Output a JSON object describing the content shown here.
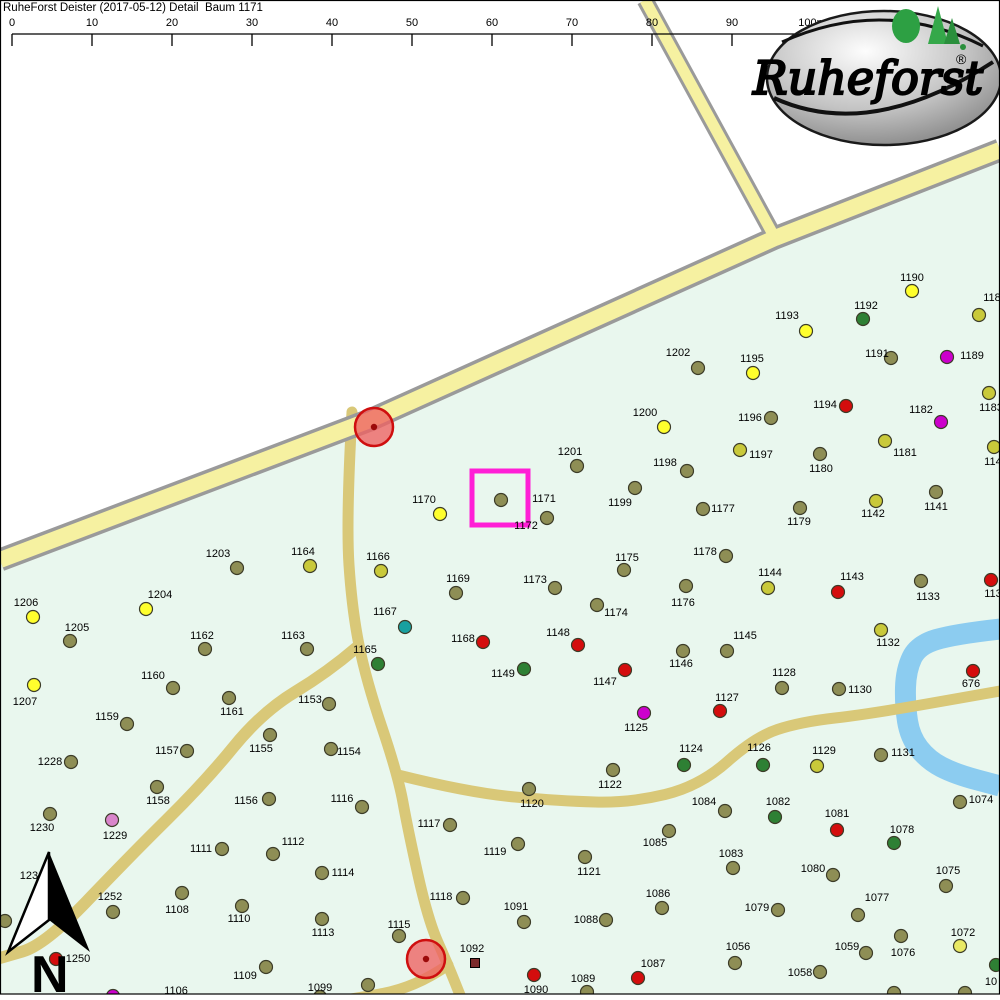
{
  "title": "RuheForst Deister (2017-05-12) Detail  Baum 1171",
  "north_label": "N",
  "logo": {
    "text": "Ruheforst",
    "reg": "®"
  },
  "scalebar": {
    "x0": 12,
    "dx": 80,
    "line_y": 34,
    "tick_h": 12,
    "label_y": 26,
    "labels": [
      "0",
      "10",
      "20",
      "30",
      "40",
      "50",
      "60",
      "70",
      "80",
      "90",
      "100m"
    ]
  },
  "colors": {
    "forest": "#e9f7ee",
    "water": "#8cccf0",
    "trail": "#d9c878",
    "road_border": "#9a9a9a",
    "road_fill": "#f6f1a1",
    "highlight": "#ff1fd6",
    "marker_fill": "#ee6161",
    "marker_border": "#cf0f0f",
    "marker_core": "#9c0a0a",
    "frame": "#000000"
  },
  "palette": {
    "olive": "#8e8e55",
    "dy": "#c9c93a",
    "y": "#ffff2d",
    "py": "#e9e964",
    "red": "#d40d0d",
    "green": "#2e8034",
    "mag": "#cc00cc",
    "teal": "#18a0a0",
    "pink": "#d985cb",
    "maroon": "#7c2b2b"
  },
  "map": {
    "forest": [
      [
        1000,
        152
      ],
      [
        775,
        238
      ],
      [
        370,
        420
      ],
      [
        0,
        558
      ],
      [
        0,
        1000
      ],
      [
        1000,
        1000
      ]
    ],
    "water": {
      "w": 21,
      "pts": [
        [
          1000,
          629
        ],
        [
          955,
          634
        ],
        [
          918,
          645
        ],
        [
          906,
          670
        ],
        [
          905,
          705
        ],
        [
          910,
          737
        ],
        [
          928,
          760
        ],
        [
          955,
          774
        ],
        [
          1000,
          786
        ]
      ]
    },
    "trails": [
      {
        "w": 11,
        "pts": [
          [
            352,
            412
          ],
          [
            346,
            520
          ],
          [
            352,
            610
          ],
          [
            366,
            680
          ],
          [
            398,
            775
          ],
          [
            408,
            830
          ],
          [
            428,
            920
          ],
          [
            448,
            965
          ],
          [
            462,
            1000
          ]
        ]
      },
      {
        "w": 11,
        "pts": [
          [
            448,
            965
          ],
          [
            415,
            988
          ],
          [
            345,
            1000
          ]
        ]
      },
      {
        "w": 11,
        "pts": [
          [
            398,
            775
          ],
          [
            470,
            793
          ],
          [
            560,
            801
          ],
          [
            630,
            803
          ],
          [
            700,
            786
          ],
          [
            755,
            737
          ],
          [
            800,
            722
          ],
          [
            870,
            714
          ],
          [
            1000,
            691
          ]
        ]
      },
      {
        "w": 12,
        "pts": [
          [
            356,
            648
          ],
          [
            328,
            672
          ],
          [
            262,
            712
          ],
          [
            205,
            782
          ],
          [
            130,
            856
          ],
          [
            45,
            945
          ],
          [
            0,
            958
          ]
        ]
      }
    ],
    "roads": [
      {
        "w": 16,
        "bw": 23,
        "pts": [
          [
            1000,
            150
          ],
          [
            775,
            238
          ],
          [
            370,
            420
          ],
          [
            0,
            560
          ]
        ]
      },
      {
        "w": 11,
        "bw": 17,
        "pts": [
          [
            645,
            0
          ],
          [
            775,
            238
          ]
        ]
      }
    ]
  },
  "markers": {
    "circles": [
      {
        "x": 374,
        "y": 427
      },
      {
        "x": 426,
        "y": 959
      }
    ],
    "highlight": {
      "x": 472,
      "y": 471,
      "w": 56,
      "h": 54
    }
  },
  "trees": [
    [
      "1190",
      912,
      291,
      912,
      277,
      "y"
    ],
    [
      "1192",
      863,
      319,
      866,
      305,
      "green"
    ],
    [
      "118",
      979,
      315,
      992,
      297,
      "dy"
    ],
    [
      "1191",
      891,
      358,
      877,
      353,
      "olive"
    ],
    [
      "1189",
      947,
      357,
      972,
      355,
      "mag"
    ],
    [
      "1183",
      989,
      393,
      991,
      407,
      "dy"
    ],
    [
      "1182",
      941,
      422,
      921,
      409,
      "mag"
    ],
    [
      "1181",
      885,
      441,
      905,
      452,
      "dy"
    ],
    [
      "1140",
      994,
      447,
      996,
      461,
      "dy"
    ],
    [
      "1194",
      846,
      406,
      825,
      404,
      "red"
    ],
    [
      "1193",
      806,
      331,
      787,
      315,
      "y"
    ],
    [
      "1195",
      753,
      373,
      752,
      358,
      "y"
    ],
    [
      "1202",
      698,
      368,
      678,
      352,
      "olive"
    ],
    [
      "1196",
      771,
      418,
      750,
      417,
      "olive"
    ],
    [
      "1200",
      664,
      427,
      645,
      412,
      "y"
    ],
    [
      "1197",
      740,
      450,
      761,
      454,
      "dy"
    ],
    [
      "1180",
      820,
      454,
      821,
      468,
      "olive"
    ],
    [
      "1201",
      577,
      466,
      570,
      451,
      "olive"
    ],
    [
      "1198",
      687,
      471,
      665,
      462,
      "olive"
    ],
    [
      "1199",
      635,
      488,
      620,
      502,
      "olive"
    ],
    [
      "1177",
      703,
      509,
      723,
      508,
      "olive"
    ],
    [
      "1179",
      800,
      508,
      799,
      521,
      "olive"
    ],
    [
      "1142",
      876,
      501,
      873,
      513,
      "dy"
    ],
    [
      "1141",
      936,
      492,
      936,
      506,
      "olive"
    ],
    [
      "1170",
      440,
      514,
      424,
      499,
      "y"
    ],
    [
      "1171",
      501,
      500,
      544,
      498,
      "olive"
    ],
    [
      "1172",
      547,
      518,
      526,
      525,
      "olive"
    ],
    [
      "1175",
      624,
      570,
      627,
      557,
      "olive"
    ],
    [
      "1178",
      726,
      556,
      705,
      551,
      "olive"
    ],
    [
      "1144",
      768,
      588,
      770,
      572,
      "dy"
    ],
    [
      "1143",
      838,
      592,
      852,
      576,
      "red"
    ],
    [
      "1176",
      686,
      586,
      683,
      602,
      "olive"
    ],
    [
      "1173",
      555,
      588,
      535,
      579,
      "olive"
    ],
    [
      "1174",
      597,
      605,
      616,
      612,
      "olive"
    ],
    [
      "1133",
      921,
      581,
      928,
      596,
      "olive"
    ],
    [
      "113",
      991,
      580,
      993,
      593,
      "red"
    ],
    [
      "1132",
      881,
      630,
      888,
      642,
      "dy"
    ],
    [
      "1164",
      310,
      566,
      303,
      551,
      "dy"
    ],
    [
      "1203",
      237,
      568,
      218,
      553,
      "olive"
    ],
    [
      "1166",
      381,
      571,
      378,
      556,
      "dy"
    ],
    [
      "1169",
      456,
      593,
      458,
      578,
      "olive"
    ],
    [
      "1204",
      146,
      609,
      160,
      594,
      "y"
    ],
    [
      "1206",
      33,
      617,
      26,
      602,
      "y"
    ],
    [
      "1205",
      70,
      641,
      77,
      627,
      "olive"
    ],
    [
      "1162",
      205,
      649,
      202,
      635,
      "olive"
    ],
    [
      "1163",
      307,
      649,
      293,
      635,
      "olive"
    ],
    [
      "1167",
      405,
      627,
      385,
      611,
      "teal"
    ],
    [
      "1168",
      483,
      642,
      463,
      638,
      "red"
    ],
    [
      "1148",
      578,
      645,
      558,
      632,
      "red"
    ],
    [
      "1165",
      378,
      664,
      365,
      649,
      "green"
    ],
    [
      "1149",
      524,
      669,
      503,
      673,
      "green"
    ],
    [
      "1147",
      625,
      670,
      605,
      681,
      "red"
    ],
    [
      "1146",
      683,
      651,
      681,
      663,
      "olive"
    ],
    [
      "1145",
      727,
      651,
      745,
      635,
      "olive"
    ],
    [
      "1128",
      782,
      688,
      784,
      672,
      "olive"
    ],
    [
      "1130",
      839,
      689,
      860,
      689,
      "olive"
    ],
    [
      "1127",
      720,
      711,
      727,
      697,
      "red"
    ],
    [
      "1125",
      644,
      713,
      636,
      727,
      "mag"
    ],
    [
      "1124",
      684,
      765,
      691,
      748,
      "green"
    ],
    [
      "1126",
      763,
      765,
      759,
      747,
      "green"
    ],
    [
      "1129",
      817,
      766,
      824,
      750,
      "dy"
    ],
    [
      "1122",
      613,
      770,
      610,
      784,
      "olive"
    ],
    [
      "1131",
      881,
      755,
      903,
      752,
      "olive"
    ],
    [
      "676",
      973,
      671,
      971,
      683,
      "red"
    ],
    [
      "1120",
      529,
      789,
      532,
      803,
      "olive"
    ],
    [
      "1117",
      450,
      825,
      429,
      823,
      "olive"
    ],
    [
      "1116",
      362,
      807,
      342,
      798,
      "olive"
    ],
    [
      "1153",
      329,
      704,
      310,
      699,
      "olive"
    ],
    [
      "1154",
      331,
      749,
      349,
      751,
      "olive"
    ],
    [
      "1155",
      270,
      735,
      261,
      748,
      "olive"
    ],
    [
      "1156",
      269,
      799,
      246,
      800,
      "olive"
    ],
    [
      "1157",
      187,
      751,
      167,
      750,
      "olive"
    ],
    [
      "1158",
      157,
      787,
      158,
      800,
      "olive"
    ],
    [
      "1159",
      127,
      724,
      107,
      716,
      "olive"
    ],
    [
      "1160",
      173,
      688,
      153,
      675,
      "olive"
    ],
    [
      "1161",
      229,
      698,
      232,
      711,
      "olive"
    ],
    [
      "1228",
      71,
      762,
      50,
      761,
      "olive"
    ],
    [
      "1229",
      112,
      820,
      115,
      835,
      "pink"
    ],
    [
      "1230",
      50,
      814,
      42,
      827,
      "olive"
    ],
    [
      "1250",
      56,
      959,
      78,
      958,
      "red"
    ],
    [
      "1252",
      113,
      912,
      110,
      896,
      "olive"
    ],
    [
      "1207",
      34,
      685,
      25,
      701,
      "y"
    ],
    [
      "1111",
      222,
      849,
      201,
      848,
      "olive"
    ],
    [
      "1112",
      273,
      854,
      293,
      841,
      "olive"
    ],
    [
      "1113",
      322,
      919,
      323,
      932,
      "olive"
    ],
    [
      "1114",
      322,
      873,
      343,
      872,
      "olive"
    ],
    [
      "1110",
      242,
      906,
      239,
      918,
      "olive"
    ],
    [
      "1108",
      182,
      893,
      177,
      909,
      "olive"
    ],
    [
      "1109",
      266,
      967,
      245,
      975,
      "olive"
    ],
    [
      "1106",
      113,
      996,
      176,
      990,
      "mag"
    ],
    [
      "1099",
      320,
      997,
      320,
      987,
      "olive"
    ],
    [
      "1098",
      368,
      985,
      378,
      998,
      "olive"
    ],
    [
      "1115",
      399,
      936,
      399,
      924,
      "olive"
    ],
    [
      "1118",
      463,
      898,
      441,
      896,
      "olive"
    ],
    [
      "1119",
      518,
      844,
      495,
      851,
      "olive"
    ],
    [
      "1121",
      585,
      857,
      589,
      871,
      "olive"
    ],
    [
      "1091",
      524,
      922,
      516,
      906,
      "olive"
    ],
    [
      "1088",
      606,
      920,
      586,
      919,
      "olive"
    ],
    [
      "1090",
      534,
      975,
      536,
      989,
      "red"
    ],
    [
      "1089",
      587,
      992,
      583,
      978,
      "olive"
    ],
    [
      "1092",
      475,
      963,
      472,
      948,
      "maroon",
      "sq"
    ],
    [
      "1087",
      638,
      978,
      653,
      963,
      "red"
    ],
    [
      "1084",
      725,
      811,
      704,
      801,
      "olive"
    ],
    [
      "1085",
      669,
      831,
      655,
      842,
      "olive"
    ],
    [
      "1082",
      775,
      817,
      778,
      801,
      "green"
    ],
    [
      "1081",
      837,
      830,
      837,
      813,
      "red"
    ],
    [
      "1078",
      894,
      843,
      902,
      829,
      "green"
    ],
    [
      "1074",
      960,
      802,
      981,
      799,
      "olive"
    ],
    [
      "1083",
      733,
      868,
      731,
      853,
      "olive"
    ],
    [
      "1080",
      833,
      875,
      813,
      868,
      "olive"
    ],
    [
      "1075",
      946,
      886,
      948,
      870,
      "olive"
    ],
    [
      "1086",
      662,
      908,
      658,
      893,
      "olive"
    ],
    [
      "1079",
      778,
      910,
      757,
      907,
      "olive"
    ],
    [
      "1077",
      858,
      915,
      877,
      897,
      "olive"
    ],
    [
      "1076",
      901,
      936,
      903,
      952,
      "olive"
    ],
    [
      "1072",
      960,
      946,
      963,
      932,
      "py"
    ],
    [
      "1059",
      866,
      953,
      847,
      946,
      "olive"
    ],
    [
      "1056",
      735,
      963,
      738,
      946,
      "olive"
    ],
    [
      "1058",
      820,
      972,
      800,
      972,
      "olive"
    ],
    [
      "10",
      996,
      965,
      991,
      981,
      "green"
    ],
    [
      "",
      894,
      993,
      0,
      0,
      "olive"
    ],
    [
      "",
      965,
      993,
      0,
      0,
      "olive"
    ],
    [
      "",
      5,
      921,
      0,
      0,
      "olive"
    ],
    [
      "1231",
      null,
      null,
      32,
      875,
      null
    ]
  ]
}
